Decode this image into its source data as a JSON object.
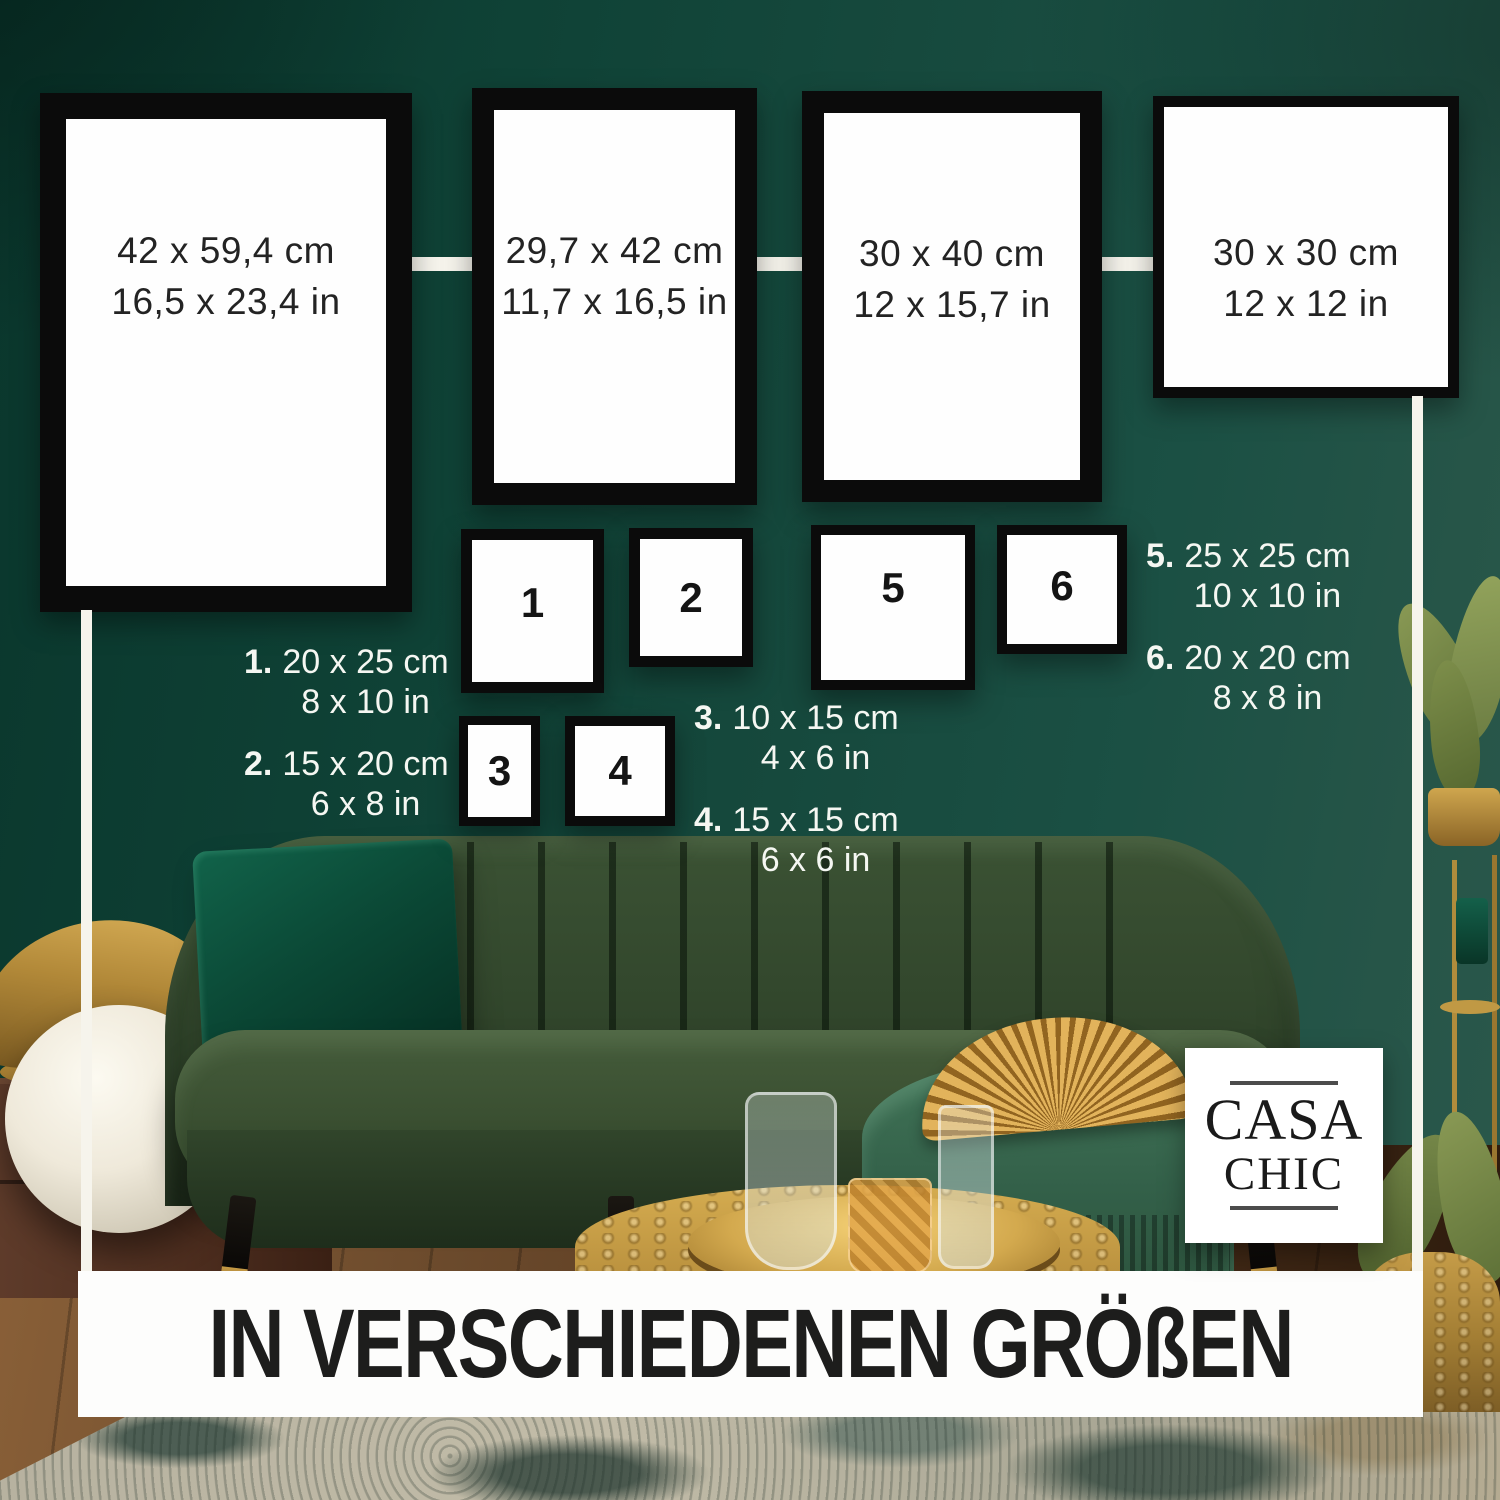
{
  "headline": "IN VERSCHIEDENEN GRÖßEN",
  "brand": {
    "word1": "CASA",
    "word2": "CHIC"
  },
  "large_frames": [
    {
      "cm": "42 x 59,4 cm",
      "inch": "16,5 x 23,4 in"
    },
    {
      "cm": "29,7 x 42 cm",
      "inch": "11,7 x 16,5 in"
    },
    {
      "cm": "30 x 40 cm",
      "inch": "12 x 15,7 in"
    },
    {
      "cm": "30 x 30 cm",
      "inch": "12 x 12 in"
    }
  ],
  "frame_numbers": [
    "1",
    "2",
    "3",
    "4",
    "5",
    "6"
  ],
  "size_legend": [
    {
      "num": "1.",
      "cm": "20 x 25 cm",
      "inch": "8 x 10 in"
    },
    {
      "num": "2.",
      "cm": "15 x 20 cm",
      "inch": "6 x 8 in"
    },
    {
      "num": "3.",
      "cm": "10 x 15 cm",
      "inch": "4 x 6 in"
    },
    {
      "num": "4.",
      "cm": "15 x 15 cm",
      "inch": "6 x 6 in"
    },
    {
      "num": "5.",
      "cm": "25 x 25 cm",
      "inch": "10 x 10 in"
    },
    {
      "num": "6.",
      "cm": "20 x 20 cm",
      "inch": "8 x 8 in"
    }
  ],
  "colors": {
    "wall_green": "#16493d",
    "frame_border": "#0b0b0b",
    "banner_bg": "#fdfdfc",
    "headline_color": "#1d1d1c",
    "legend_color": "#f5f7f2",
    "accent_gold": "#c99d4d"
  }
}
